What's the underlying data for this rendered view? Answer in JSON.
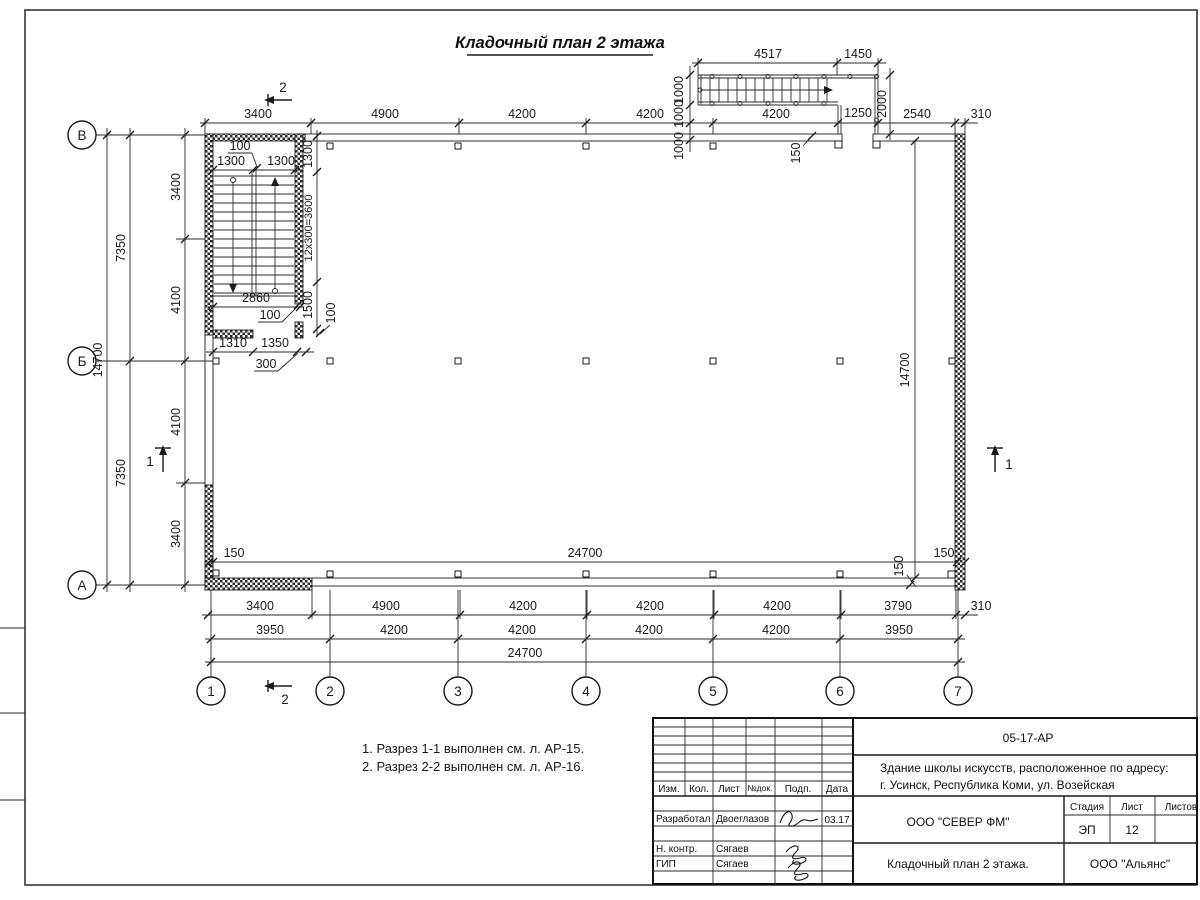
{
  "title": "Кладочный план 2 этажа",
  "notes": {
    "line1": "1. Разрез 1-1 выполнен см. л. АР-15.",
    "line2": "2. Разрез 2-2 выполнен см. л. АР-16."
  },
  "axes": {
    "left": [
      "В",
      "Б",
      "А"
    ],
    "bottom": [
      "1",
      "2",
      "3",
      "4",
      "5",
      "6",
      "7"
    ]
  },
  "sections": {
    "one": "1",
    "two": "2"
  },
  "dims": {
    "top": [
      "3400",
      "4900",
      "4200",
      "4200",
      "4200",
      "1250",
      "2540",
      "310"
    ],
    "ext": {
      "d4517": "4517",
      "d1450": "1450",
      "t1000a": "1000",
      "t1000b": "1000",
      "t1000c": "1000",
      "d2000": "2000",
      "d150": "150"
    },
    "stair": {
      "d100t": "100",
      "d1300a": "1300",
      "d1300b": "1300",
      "r1300": "1300",
      "r3600": "12x300=3600",
      "r1500": "1500",
      "r100": "100",
      "d2860": "2860",
      "d100m": "100",
      "d1310": "1310",
      "d1350": "1350",
      "d300": "300"
    },
    "left": {
      "inner": [
        "3400",
        "4100",
        "4100",
        "3400"
      ],
      "mid": [
        "7350",
        "7350"
      ],
      "total": "14700"
    },
    "inner": {
      "w150l": "150",
      "w24700": "24700",
      "w150r": "150",
      "h14700": "14700",
      "w150b": "150"
    },
    "bottom1": [
      "3400",
      "4900",
      "4200",
      "4200",
      "4200",
      "3790",
      "310"
    ],
    "bottom2": [
      "3950",
      "4200",
      "4200",
      "4200",
      "4200",
      "3950"
    ],
    "bottom3": "24700"
  },
  "titleblock": {
    "code": "05-17-АР",
    "address1": "Здание школы искусств, расположенное по адресу:",
    "address2": "г. Усинск, Республика Коми, ул. Возейская",
    "cols": {
      "izm": "Изм.",
      "kol": "Кол.",
      "list": "Лист",
      "ndok": "№док.",
      "podp": "Подп.",
      "data": "Дата"
    },
    "rows": {
      "r1role": "Разработал",
      "r1name": "Двоеглазов",
      "r1date": "03.17",
      "r2role": "Н. контр.",
      "r2name": "Сягаев",
      "r3role": "ГИП",
      "r3name": "Сягаев"
    },
    "company": "ООО \"СЕВЕР ФМ\"",
    "stage": {
      "h1": "Стадия",
      "h2": "Лист",
      "h3": "Листов",
      "v1": "ЭП",
      "v2": "12"
    },
    "sheet_title": "Кладочный план 2 этажа.",
    "org": "ООО \"Альянс\""
  }
}
